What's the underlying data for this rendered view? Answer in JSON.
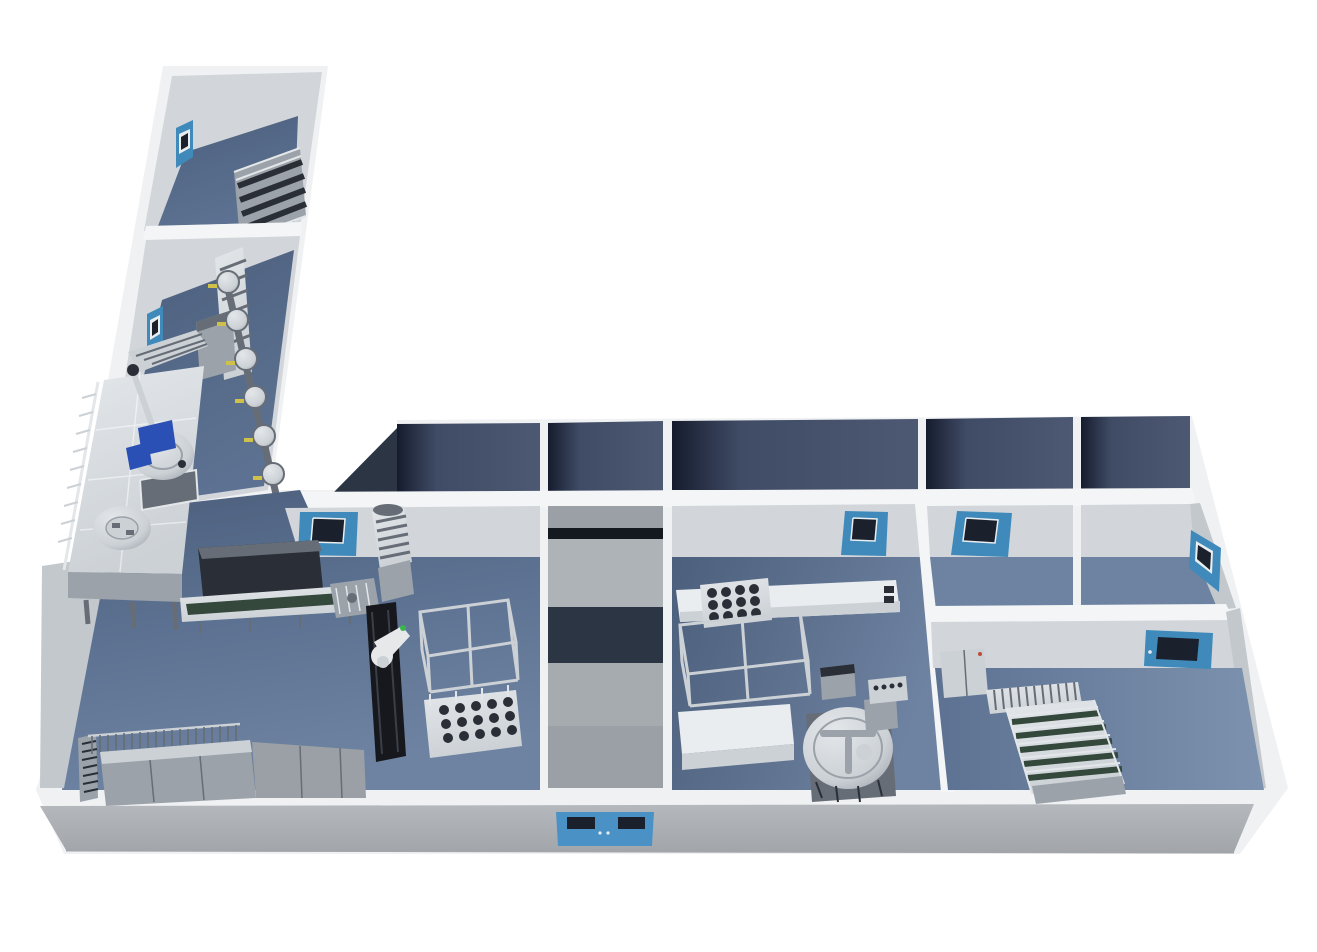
{
  "scene": {
    "description": "3D isometric rendering of an L-shaped pharmaceutical production facility floor plan",
    "rooms": [
      {
        "name": "storage-room",
        "position": "top-left-wing-upper"
      },
      {
        "name": "prep-room",
        "position": "top-left-wing-lower"
      },
      {
        "name": "main-production-hall",
        "position": "west-main-wing"
      },
      {
        "name": "central-corridor-core",
        "position": "center-main-wing"
      },
      {
        "name": "filling-room",
        "position": "center-east-main-wing"
      },
      {
        "name": "airlock-room-a",
        "position": "north-east"
      },
      {
        "name": "airlock-room-b",
        "position": "north-east-corner"
      },
      {
        "name": "packing-room",
        "position": "south-east"
      }
    ],
    "equipment": [
      "tray-rack",
      "bucket-elevator",
      "filter-vessel-line",
      "mezzanine-platform",
      "mixing-vessel-with-agitator",
      "vessel-lid",
      "access-stair",
      "long-conveyor",
      "incline-conveyor",
      "robot-on-linear-rail",
      "stainless-frame-skid",
      "cylinder-tray-rack",
      "wash-rack",
      "bench-row",
      "white-cabinet-line",
      "white-trough",
      "rotary-accumulation-table",
      "filling-machine",
      "accumulation-conveyor",
      "utility-cabinet",
      "pass-through-hatch"
    ],
    "doors": [
      "storage-room-door",
      "prep-room-door",
      "main-hall-door",
      "filling-room-door",
      "airlock-a-door",
      "airlock-b-east-door",
      "packing-room-door",
      "front-pass-through"
    ]
  },
  "palette": {
    "white": "#ffffff",
    "building_white": "#eff1f3",
    "wall_cap": "#f3f5f6",
    "wall_face": "#d2d6da",
    "wall_face_shade": "#c3c8cd",
    "wall_face_dark": "#b2b8be",
    "floor": "#5d7292",
    "floor_dark": "#4c5f7d",
    "floor_light": "#6e83a1",
    "floor_lighter": "#7d92ae",
    "band_dark": "#161c2e",
    "band_mid": "#404c66",
    "band_light": "#4d5973",
    "door_blue": "#3f8aba",
    "door_blue_light": "#55a1cd",
    "window_dark": "#1b212c",
    "frame_white": "#e9edf0",
    "steel_bright": "#e3e7ea",
    "steel_light": "#ccd1d6",
    "steel_mid": "#9ba2a9",
    "steel_dark": "#666d76",
    "steel_black": "#2a2f37",
    "rail_black": "#16181d",
    "robot_white": "#e6e8ea",
    "agitator_blue": "#2a4fb5",
    "valve_yellow": "#cfc04a",
    "convey_green": "#35483c",
    "core_gray_a": "#9aa0a5",
    "core_dark_a": "#141920",
    "core_gray_b": "#aeb3b8",
    "core_dark_b": "#2c3543",
    "core_gray_c": "#a6abb0",
    "front_face": "#b5b9bd",
    "front_face_dark": "#a2a6ab",
    "pass_blue": "#4a92c6",
    "shadow": "#3a414c",
    "robot_green_dot": "#39b54a"
  }
}
